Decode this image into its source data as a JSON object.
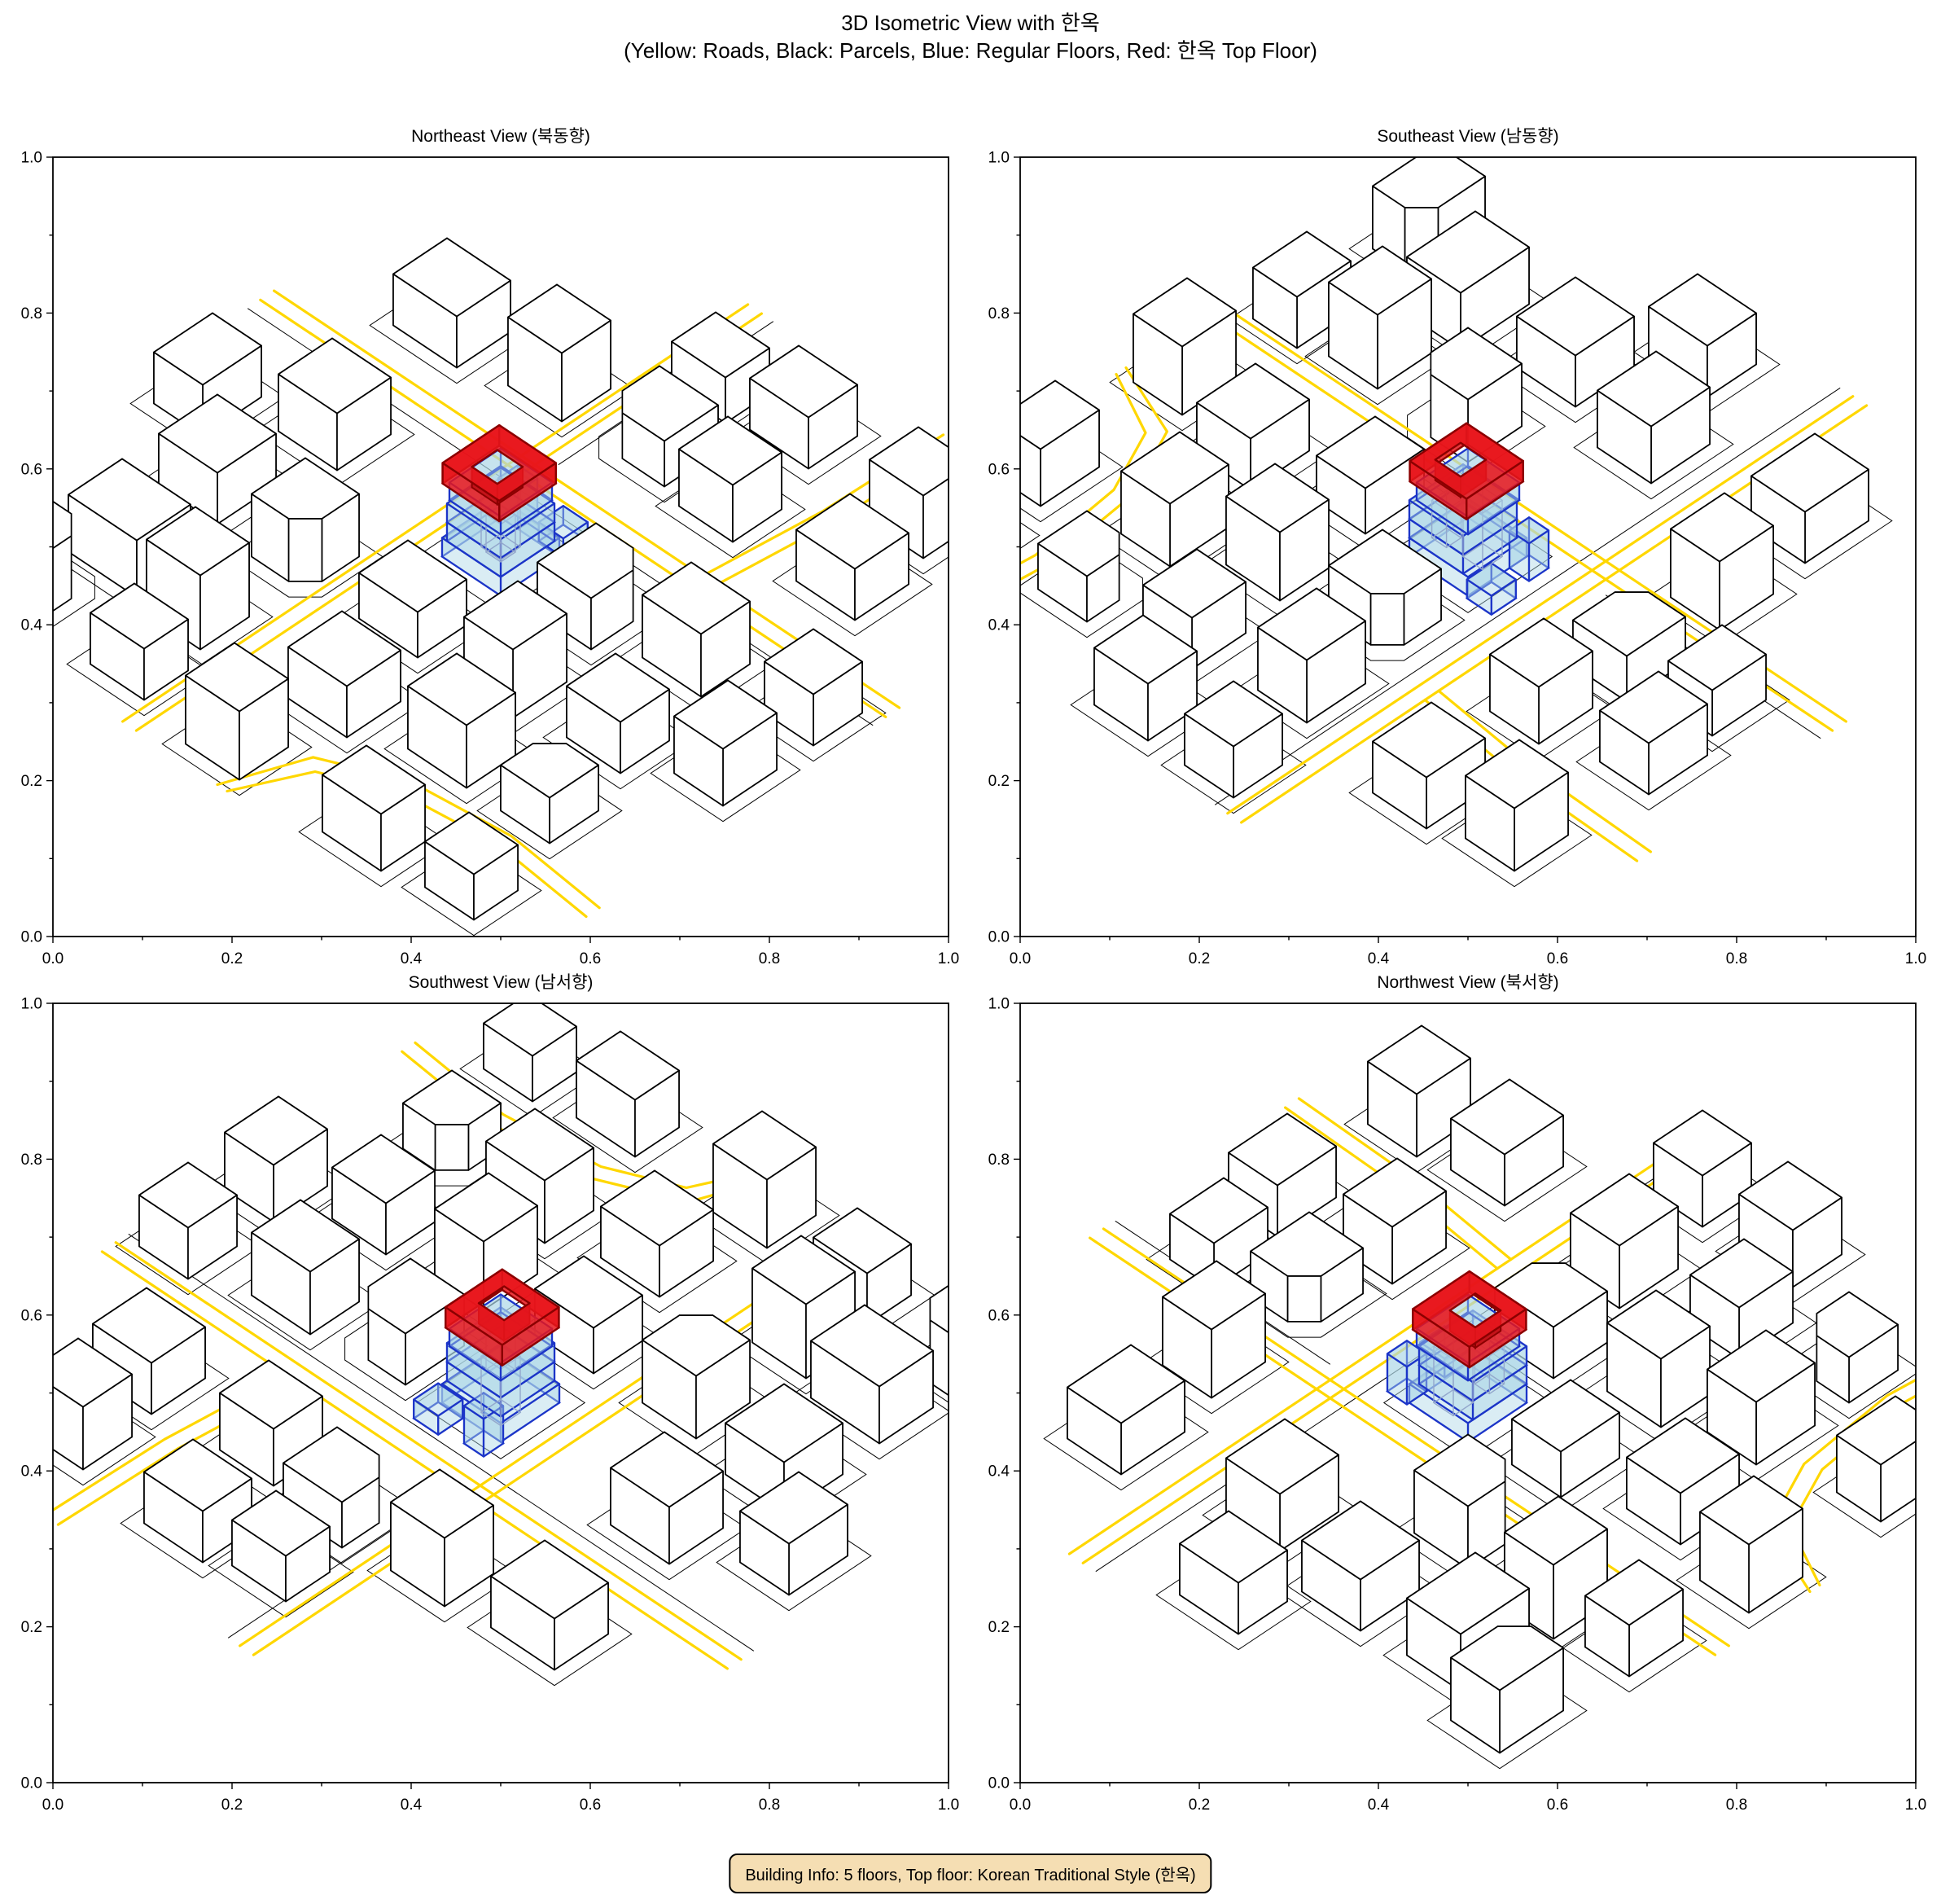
{
  "figure": {
    "title": "3D Isometric View with 한옥",
    "subtitle": "(Yellow: Roads, Black: Parcels, Blue: Regular Floors, Red: 한옥 Top Floor)"
  },
  "footer": {
    "building_info": "Building Info: 5 floors, Top floor: Korean Traditional Style (한옥)"
  },
  "chart_data": {
    "type": "other",
    "subtype": "3d-isometric-city-multiview",
    "title": "3D Isometric View with 한옥",
    "legend": {
      "yellow": "Roads",
      "black": "Parcels",
      "blue": "Regular Floors",
      "red": "한옥 Top Floor"
    },
    "building_info": {
      "floors": 5,
      "regular_floors": 4,
      "top_floor_style": "Korean Traditional Style (한옥)"
    },
    "axes": {
      "xlim": [
        0,
        1
      ],
      "ylim": [
        0,
        1
      ],
      "xticks": [
        "0.0",
        "0.2",
        "0.4",
        "0.6",
        "0.8",
        "1.0"
      ],
      "yticks": [
        "0.0",
        "0.2",
        "0.4",
        "0.6",
        "0.8",
        "1.0"
      ],
      "minor_tick_step": 0.1
    },
    "views": [
      {
        "id": "northeast",
        "title": "Northeast View (북동향)",
        "azimuth_deg": 0
      },
      {
        "id": "southeast",
        "title": "Southeast View (남동향)",
        "azimuth_deg": 270
      },
      {
        "id": "southwest",
        "title": "Southwest View (남서향)",
        "azimuth_deg": 180
      },
      {
        "id": "northwest",
        "title": "Northwest View (북서향)",
        "azimuth_deg": 90
      }
    ],
    "colors": {
      "road": "#FFD700",
      "parcel": "#000000",
      "building_fill": "#FFFFFF",
      "building_edge": "#000000",
      "floor_fill": "#ADD8E6",
      "floor_edge": "#1C35C8",
      "hanok_fill": "#E8151B",
      "hanok_inner": "#C11117",
      "hanok_edge": "#8B0000",
      "wire_edge": "#93A7CC",
      "badge_bg": "#F5DEB3",
      "badge_border": "#000000",
      "axis": "#000000"
    },
    "scene": {
      "roads": [
        {
          "pts": [
            [
              -64,
              -14.8
            ],
            [
              64,
              -14.8
            ]
          ]
        },
        {
          "pts": [
            [
              -64,
              -17.6
            ],
            [
              64,
              -17.6
            ]
          ]
        },
        {
          "pts": [
            [
              -13.4,
              -64
            ],
            [
              -13.4,
              64
            ]
          ]
        },
        {
          "pts": [
            [
              -10.6,
              -64
            ],
            [
              -10.6,
              64
            ]
          ]
        },
        {
          "pts": [
            [
              23.6,
              -17.6
            ],
            [
              26,
              -40
            ],
            [
              26.6,
              -64
            ]
          ]
        },
        {
          "pts": [
            [
              26.4,
              -17.6
            ],
            [
              28.8,
              -40
            ],
            [
              29.4,
              -64
            ]
          ]
        },
        {
          "pts": [
            [
              8,
              64
            ],
            [
              14,
              52
            ],
            [
              26,
              46.5
            ],
            [
              44,
              44.5
            ],
            [
              64,
              46.5
            ]
          ]
        },
        {
          "pts": [
            [
              6,
              64
            ],
            [
              11.6,
              50
            ],
            [
              25,
              43.8
            ],
            [
              44,
              41.8
            ],
            [
              64,
              43.8
            ]
          ]
        }
      ],
      "parcel_lines": [
        {
          "pts": [
            [
              -64,
              -12.2
            ],
            [
              64,
              -12.2
            ]
          ]
        },
        {
          "pts": [
            [
              -8.2,
              -64
            ],
            [
              -8.2,
              -20
            ]
          ]
        }
      ],
      "buildings": [
        [
          -38,
          38,
          14,
          11,
          10
        ],
        [
          -22,
          40,
          11,
          10,
          13
        ],
        [
          6,
          38,
          12,
          11,
          9
        ],
        [
          26,
          34,
          12,
          10,
          11
        ],
        [
          44,
          34,
          10,
          10,
          8,
          0
        ],
        [
          -40,
          18,
          12,
          12,
          9
        ],
        [
          -20,
          20,
          11,
          11,
          11,
          2
        ],
        [
          1,
          19,
          12,
          10,
          8
        ],
        [
          21,
          18,
          10,
          11,
          12
        ],
        [
          40,
          16,
          11,
          10,
          9
        ],
        [
          -36,
          -2,
          12,
          11,
          10
        ],
        [
          18,
          -1,
          11,
          12,
          9,
          1
        ],
        [
          36,
          -4,
          12,
          10,
          11
        ],
        [
          -40,
          -30,
          13,
          11,
          9
        ],
        [
          -20,
          -32,
          11,
          10,
          12
        ],
        [
          0,
          -33,
          12,
          11,
          8,
          3
        ],
        [
          16,
          -31,
          11,
          10,
          10
        ],
        [
          40,
          -32,
          12,
          11,
          9
        ],
        [
          -3,
          -48,
          11,
          9,
          8
        ],
        [
          12,
          -50,
          12,
          10,
          9
        ],
        [
          38,
          -48,
          11,
          10,
          11
        ],
        [
          30,
          56,
          12,
          9,
          10
        ],
        [
          48,
          54,
          10,
          9,
          8
        ],
        [
          -44,
          52,
          13,
          10,
          11,
          1
        ],
        [
          -20,
          54,
          11,
          9,
          9
        ],
        [
          2,
          56,
          11,
          10,
          12
        ],
        [
          -54,
          6,
          10,
          12,
          9
        ],
        [
          56,
          10,
          10,
          11,
          10
        ],
        [
          56,
          -8,
          10,
          10,
          9
        ]
      ],
      "hanok": {
        "floors": [
          {
            "x": 0,
            "y": 0,
            "w": 12,
            "d": 12,
            "z0": 0,
            "z1": 3.3
          },
          {
            "x": 0.5,
            "y": 0.5,
            "w": 11,
            "d": 11,
            "z0": 3.3,
            "z1": 6.6
          },
          {
            "x": 0.5,
            "y": 0.5,
            "w": 11,
            "d": 11,
            "z0": 6.6,
            "z1": 9.9
          },
          {
            "x": 0,
            "y": 0,
            "w": 10.5,
            "d": 10.5,
            "z0": 9.9,
            "z1": 13
          }
        ],
        "annexes": [
          {
            "x": 4,
            "y": -8.8,
            "w": 5,
            "d": 5,
            "z0": 0,
            "z1": 3.3
          },
          {
            "x": -4.5,
            "y": -8,
            "w": 4,
            "d": 4,
            "z0": 0,
            "z1": 6.6
          }
        ],
        "wires": [
          {
            "x": -1.5,
            "y": -1.5,
            "w": 4,
            "d": 4,
            "z0": 0,
            "z1": 9.9
          },
          {
            "x": 2.2,
            "y": 2.2,
            "w": 3,
            "d": 3,
            "z0": 3.3,
            "z1": 9.9
          }
        ],
        "ring": {
          "x": 0,
          "y": 0.3,
          "w": 11.6,
          "d": 11.6,
          "hx": 0.4,
          "hy": 1.1,
          "hw": 5.2,
          "hd": 5.2,
          "z0": 13,
          "z1": 16.6
        }
      }
    }
  }
}
